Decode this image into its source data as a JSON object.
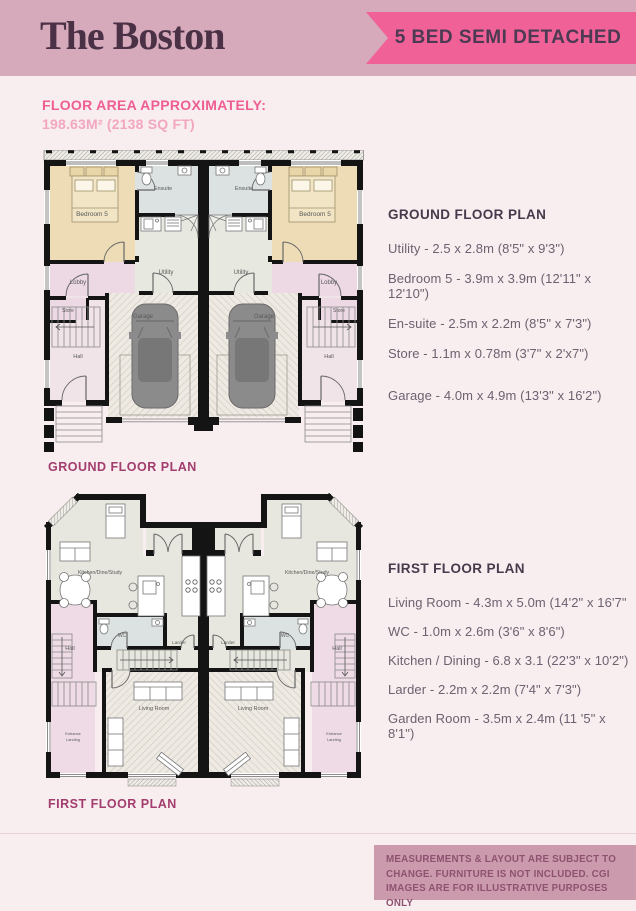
{
  "header": {
    "title": "The Boston",
    "banner": "5 BED SEMI DETACHED"
  },
  "floor_area": {
    "label": "FLOOR AREA APPROXIMATELY:",
    "value": "198.63M² (2138 SQ FT)"
  },
  "ground_floor": {
    "caption": "GROUND FLOOR PLAN",
    "panel_heading": "GROUND FLOOR PLAN",
    "specs": [
      "Utility - 2.5 x 2.8m (8'5\" x 9'3\")",
      "Bedroom 5 - 3.9m x 3.9m (12'11\" x 12'10\")",
      "En-suite - 2.5m x 2.2m (8'5\" x 7'3\")",
      "Store - 1.1m x 0.78m (3'7\" x 2'x7\")"
    ],
    "garage_spec": "Garage - 4.0m x 4.9m (13'3\" x 16'2\")",
    "rooms": {
      "bedroom": "Bedroom 5",
      "ensuite": "Ensuite",
      "utility": "Utility",
      "lobby": "Lobby",
      "store": "Store",
      "hall": "Hall",
      "garage": "Garage"
    }
  },
  "first_floor": {
    "caption": "FIRST FLOOR PLAN",
    "panel_heading": "FIRST FLOOR PLAN",
    "specs": [
      "Living Room - 4.3m x 5.0m (14'2\" x 16'7\"",
      "WC - 1.0m x 2.6m (3'6\" x 8'6\")",
      "Kitchen / Dining - 6.8 x 3.1 (22'3\" x 10'2\")",
      "Larder - 2.2m x 2.2m (7'4\" x 7'3\")",
      "Garden Room - 3.5m x 2.4m (11 '5\" x 8'1\")"
    ],
    "rooms": {
      "kitchen": "Kitchen/Dine/Study",
      "hall": "Hall",
      "wc": "WC",
      "larder": "Larder",
      "living": "Living Room",
      "entrance_line1": "Entrance",
      "entrance_line2": "Landing"
    }
  },
  "disclaimer": "MEASUREMENTS & LAYOUT ARE SUBJECT TO CHANGE. FURNITURE IS NOT INCLUDED. CGI IMAGES ARE FOR ILLUSTRATIVE PURPOSES ONLY",
  "colors": {
    "header_bg": "#d6aabb",
    "banner_bg": "#ef6197",
    "accent_pink": "#ee5e93",
    "caption_plum": "#a23d6d",
    "page_bg": "#f8edef",
    "disclaimer_bg": "#cb9bad"
  }
}
